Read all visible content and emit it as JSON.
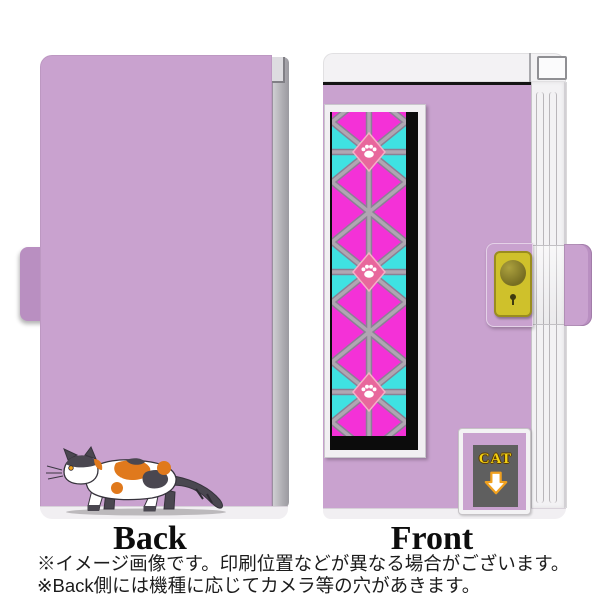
{
  "views": {
    "back": {
      "label": "Back"
    },
    "front": {
      "label": "Front"
    }
  },
  "front_badge": {
    "text": "CAT"
  },
  "footnotes": [
    "※イメージ画像です。印刷位置などが異なる場合がございます。",
    "※Back側には機種に応じてカメラ等の穴があきます。"
  ],
  "colors": {
    "case-purple": "#c9a2cf",
    "case-purple-dark": "#b98fc1",
    "pattern-magenta": "#f431d7",
    "pattern-cyan": "#3fe2e2",
    "pattern-line": "#b0a6b2",
    "pattern-line-dark": "#8b8095",
    "diamond-pink": "#e8679c",
    "diamond-border": "#f6aec7",
    "spine-white": "#f3f2f4",
    "back-edge-gray": "#b5b4b8",
    "button-yellow": "#cfc12b",
    "button-olive": "#8f8526",
    "cat-dark": "#4a4750",
    "cat-orange": "#e0791c",
    "label-bg": "#5f5f5f",
    "label-yellow": "#f5d312",
    "arrow-orange": "#f0a01e"
  }
}
